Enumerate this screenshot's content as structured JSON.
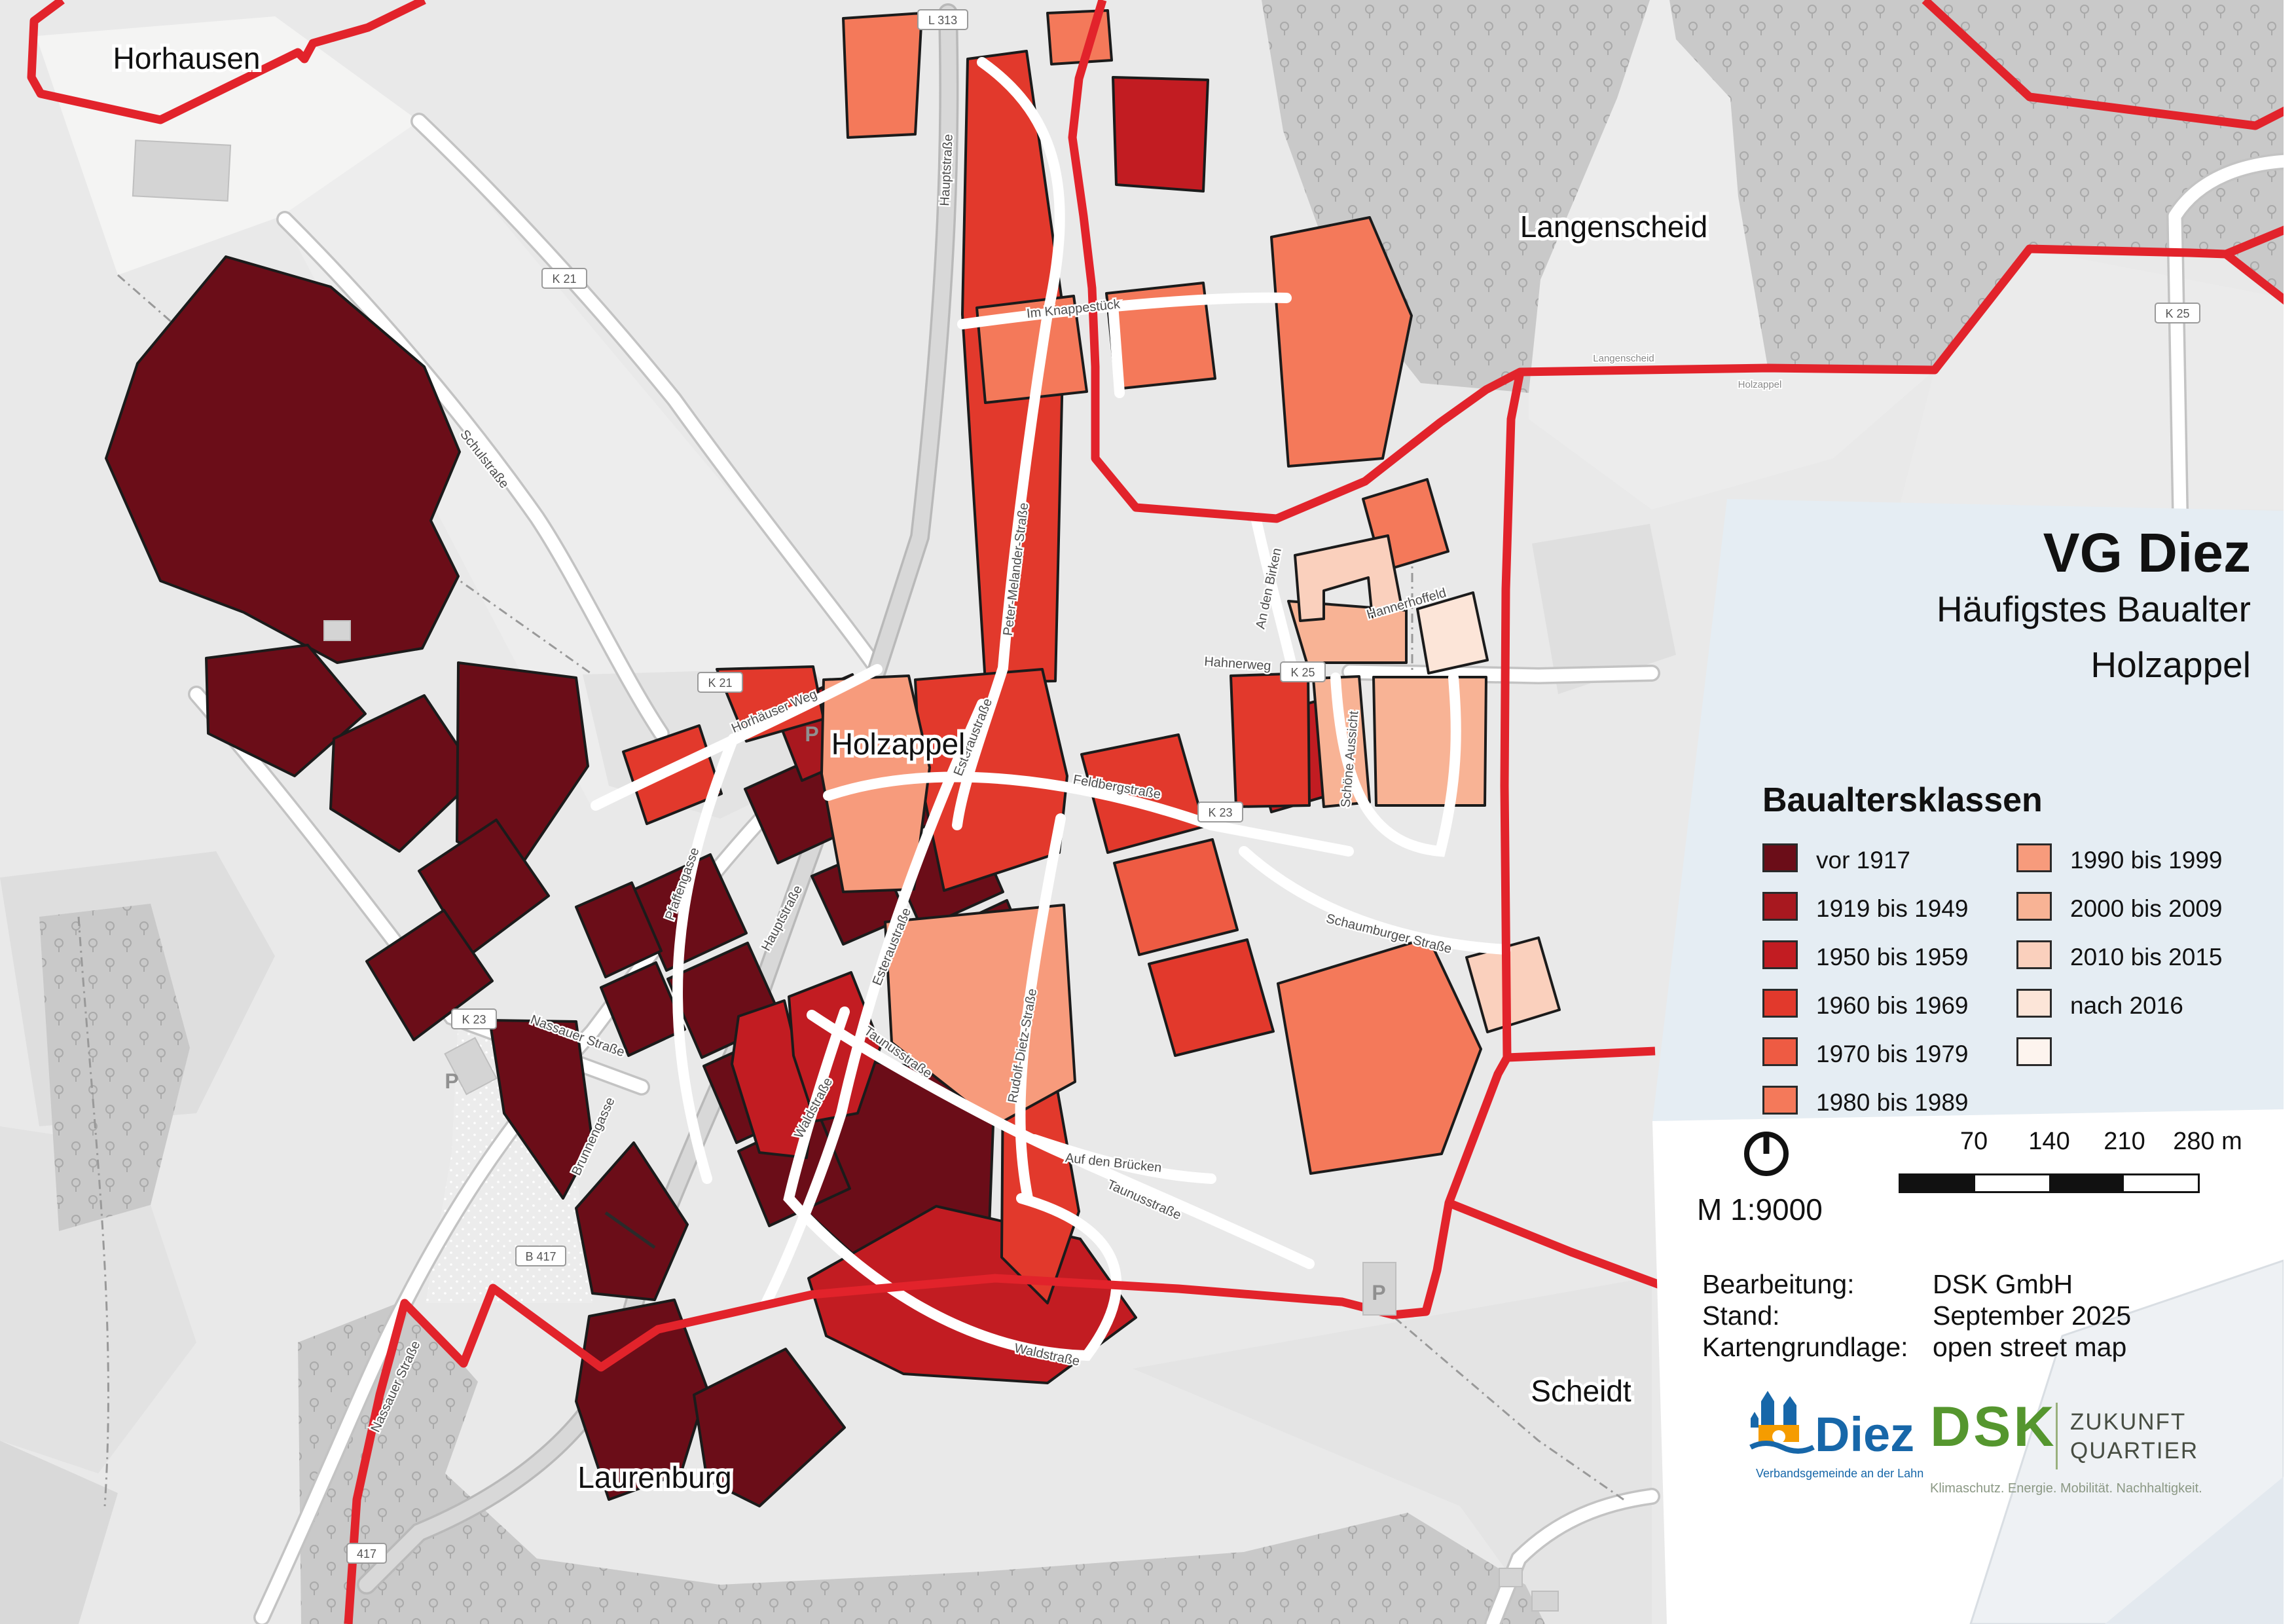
{
  "title_block": {
    "title": "VG Diez",
    "subtitle": "Häufigstes Baualter",
    "area": "Holzappel"
  },
  "legend": {
    "heading": "Baualtersklassen",
    "items": [
      {
        "label": "vor 1917",
        "color": "#6b0d18"
      },
      {
        "label": "1919 bis 1949",
        "color": "#a8181f"
      },
      {
        "label": "1950 bis 1959",
        "color": "#c21c22"
      },
      {
        "label": "1960 bis 1969",
        "color": "#e2392c"
      },
      {
        "label": "1970 bis 1979",
        "color": "#ee5b43"
      },
      {
        "label": "1980 bis 1989",
        "color": "#f4795a"
      },
      {
        "label": "1990 bis 1999",
        "color": "#f79b7c"
      },
      {
        "label": "2000 bis 2009",
        "color": "#f8b395"
      },
      {
        "label": "2010 bis 2015",
        "color": "#fad0bd"
      },
      {
        "label": "nach 2016",
        "color": "#fce5d8"
      },
      {
        "label": "",
        "color": "#fdf4ee"
      }
    ]
  },
  "scalebar": {
    "scale_text": "M 1:9000",
    "ticks": [
      "70",
      "140",
      "210",
      "280 m"
    ]
  },
  "credits": {
    "rows": [
      {
        "label": "Bearbeitung:",
        "value": "DSK GmbH"
      },
      {
        "label": "Stand:",
        "value": "September 2025"
      },
      {
        "label": "Kartengrundlage:",
        "value": "open street map"
      }
    ]
  },
  "logos": {
    "diez": {
      "name": "Diez",
      "subtitle": "Verbandsgemeinde an der Lahn",
      "blue": "#1767a9",
      "orange": "#f59c00"
    },
    "dsk": {
      "name": "DSK",
      "line1": "ZUKUNFT",
      "line2": "QUARTIER",
      "tagline": "Klimaschutz. Energie. Mobilität. Nachhaltigkeit.",
      "green": "#55962e"
    }
  },
  "map": {
    "boundary_color": "#e2232b",
    "place_labels": [
      {
        "text": "Horhausen"
      },
      {
        "text": "Langenscheid"
      },
      {
        "text": "Holzappel"
      },
      {
        "text": "Laurenburg"
      },
      {
        "text": "Scheidt"
      }
    ],
    "boundary_names": [
      {
        "text": "Langenscheid"
      },
      {
        "text": "Holzappel"
      }
    ],
    "streets": [
      {
        "text": "Hauptstraße"
      },
      {
        "text": "Hauptstraße"
      },
      {
        "text": "Nassauer Straße"
      },
      {
        "text": "Nassauer Straße"
      },
      {
        "text": "Schulstraße"
      },
      {
        "text": "Esteraustraße"
      },
      {
        "text": "Esteraustraße"
      },
      {
        "text": "Pfaffengasse"
      },
      {
        "text": "Taunusstraße"
      },
      {
        "text": "Taunusstraße"
      },
      {
        "text": "Feldbergstraße"
      },
      {
        "text": "Waldstraße"
      },
      {
        "text": "Waldstraße"
      },
      {
        "text": "Peter-Melander-Straße"
      },
      {
        "text": "Horhäuser Weg"
      },
      {
        "text": "Im Knappestück"
      },
      {
        "text": "Schaumburger Straße"
      },
      {
        "text": "An den Birken"
      },
      {
        "text": "Hahnerweg"
      },
      {
        "text": "Schöne Aussicht"
      },
      {
        "text": "Rudolf-Dietz-Straße"
      },
      {
        "text": "Auf den Brücken"
      },
      {
        "text": "Hannerhoffeld"
      },
      {
        "text": "Brunnengasse"
      }
    ],
    "road_shields": [
      {
        "text": "K 21"
      },
      {
        "text": "K 21"
      },
      {
        "text": "K 23"
      },
      {
        "text": "K 23"
      },
      {
        "text": "K 25"
      },
      {
        "text": "K 25"
      },
      {
        "text": "L 313"
      },
      {
        "text": "B 417"
      },
      {
        "text": "417"
      }
    ],
    "parking_label": "P"
  }
}
